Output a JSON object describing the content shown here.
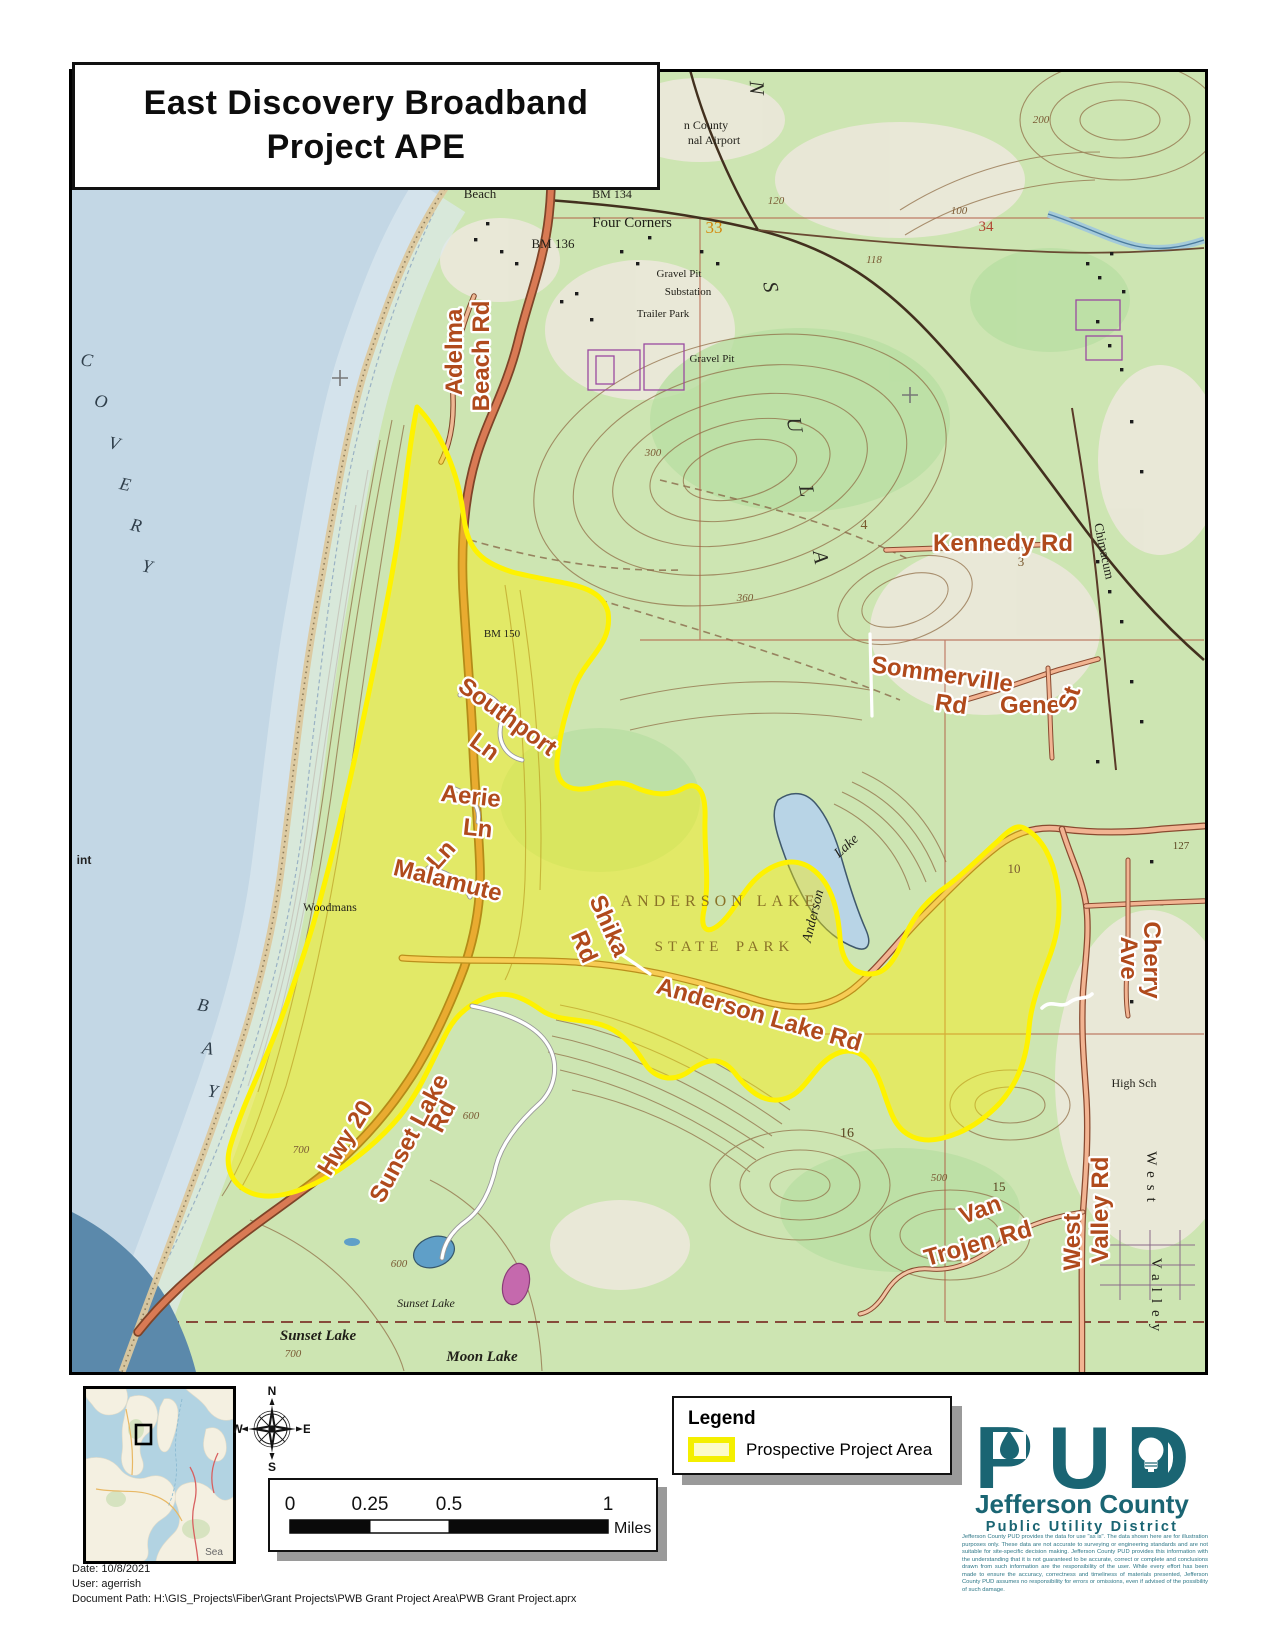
{
  "title": {
    "line1": "East Discovery Broadband",
    "line2": "Project APE"
  },
  "map": {
    "roads": {
      "adelma": "Adelma",
      "adelma2": "Beach Rd",
      "kennedy": "Kennedy Rd",
      "sommerville1": "Sommerville",
      "sommerville2": "Rd",
      "gene": "Gene",
      "gene_st": "St",
      "southport1": "Southport",
      "southport2": "Ln",
      "aerie1": "Aerie",
      "aerie2": "Ln",
      "malamute_ln": "Ln",
      "malamute": "Malamute",
      "shika1": "Shika",
      "shika2": "Rd",
      "anderson_lake_rd": "Anderson Lake Rd",
      "hwy20": "Hwy 20",
      "sunset1": "Sunset Lake",
      "sunset2": "Rd",
      "cherry1": "Cherry",
      "cherry2": "Ave",
      "west_valley1": "West",
      "west_valley2": "Valley Rd",
      "van1": "Van",
      "van2": "Trojen Rd"
    },
    "places": {
      "beach": "Beach",
      "four_corners": "Four Corners",
      "bm134": "BM 134",
      "bm136": "BM 136",
      "bm150": "BM 150",
      "gravel_pit1": "Gravel Pit",
      "substation": "Substation",
      "trailer_park": "Trailer Park",
      "gravel_pit2": "Gravel Pit",
      "airport1": "n County",
      "airport2": "nal Airport",
      "woodmans": "Woodmans",
      "sunset_lake_script": "Sunset Lake",
      "sunset_lake": "Sunset Lake",
      "moon_lake": "Moon Lake",
      "high_sch": "High Sch",
      "west_vert": "West",
      "valley_vert": "Valley",
      "chimacum": "Chimacum",
      "anderson_lk1": "Anderson",
      "anderson_lk2": "Lake",
      "point": "int"
    },
    "park": {
      "l1": "ANDERSON LAKE",
      "l2": "STATE",
      "l3": "PARK"
    },
    "sections": {
      "s33": "33",
      "s34": "34",
      "s4": "4",
      "s3": "3",
      "s10": "10",
      "s16": "16",
      "s15": "15",
      "e127": "127"
    },
    "contours": {
      "c200a": "200",
      "c120": "120",
      "c100": "100",
      "c118": "118",
      "c300": "300",
      "c360": "360",
      "c600a": "600",
      "c700a": "700",
      "c500": "500",
      "c700b": "700",
      "c600b": "600"
    },
    "bay_letters": {
      "c": "C",
      "o": "O",
      "v": "V",
      "e": "E",
      "r": "R",
      "y": "Y",
      "b": "B",
      "a": "A",
      "y2": "Y"
    },
    "peninsula_letters": {
      "n": "N",
      "s": "S",
      "u": "U",
      "l": "L",
      "a": "A"
    }
  },
  "legend": {
    "title": "Legend",
    "item_label": "Prospective Project Area",
    "swatch_fill": "#fcfbc8",
    "swatch_stroke": "#f4ef00"
  },
  "scale_bar": {
    "t0": "0",
    "t25": "0.25",
    "t50": "0.5",
    "t1": "1",
    "unit": "Miles"
  },
  "compass": {
    "n": "N",
    "e": "E",
    "s": "S",
    "w": "W"
  },
  "inset": {
    "corner_label": "Sea"
  },
  "logo": {
    "acronym": "PUD",
    "org": "Jefferson County",
    "org_sub": "Public Utility District",
    "disclaimer": "Jefferson County PUD provides the data for use \"as is\". The data shown here are for illustration purposes only. These data are not accurate to surveying or engineering standards and are not suitable for site-specific decision making. Jefferson County PUD provides this information with the understanding that it is not guaranteed to be accurate, correct or complete and conclusions drawn from such information are the responsibility of the user. While every effort has been made to ensure the accuracy, correctness and timeliness of materials presented, Jefferson County PUD assumes no responsibility for errors or omissions, even if advised of the possibility of such damage."
  },
  "footer": {
    "date": "Date: 10/8/2021",
    "user": "User: agerrish",
    "path": "Document Path: H:\\GIS_Projects\\Fiber\\Grant Projects\\PWB Grant Project Area\\PWB Grant Project.aprx"
  },
  "colors": {
    "project_area_yellow": "#fff200",
    "road_label_orange": "#b04a1c",
    "pud_teal": "#1a6573",
    "water_blue": "#c3d7e5",
    "land_green": "#cde5b2"
  }
}
